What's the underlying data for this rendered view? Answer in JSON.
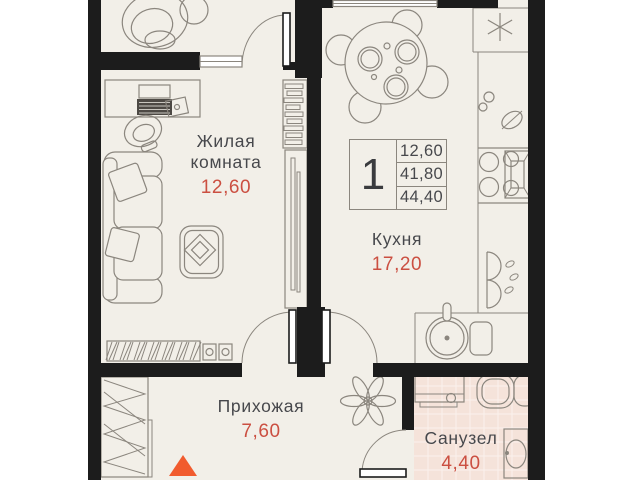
{
  "colors": {
    "wall": "#1c1c1c",
    "floor": "#f2efe8",
    "bath": "#f5e3da",
    "line": "#8b867e",
    "ink": "#47484c",
    "accent": "#cb4f41",
    "entrance": "#f15b2e"
  },
  "legend": {
    "unit_rooms": "1",
    "values": [
      "12,60",
      "41,80",
      "44,40"
    ]
  },
  "rooms": {
    "living": {
      "name_line1": "Жилая",
      "name_line2": "комната",
      "area": "12,60"
    },
    "kitchen": {
      "name": "Кухня",
      "area": "17,20"
    },
    "hallway": {
      "name": "Прихожая",
      "area": "7,60"
    },
    "bathroom": {
      "name": "Санузел",
      "area": "4,40"
    }
  },
  "icons": {
    "fridge": "snowflake-asterisk",
    "entrance": "orange-triangle-up"
  }
}
